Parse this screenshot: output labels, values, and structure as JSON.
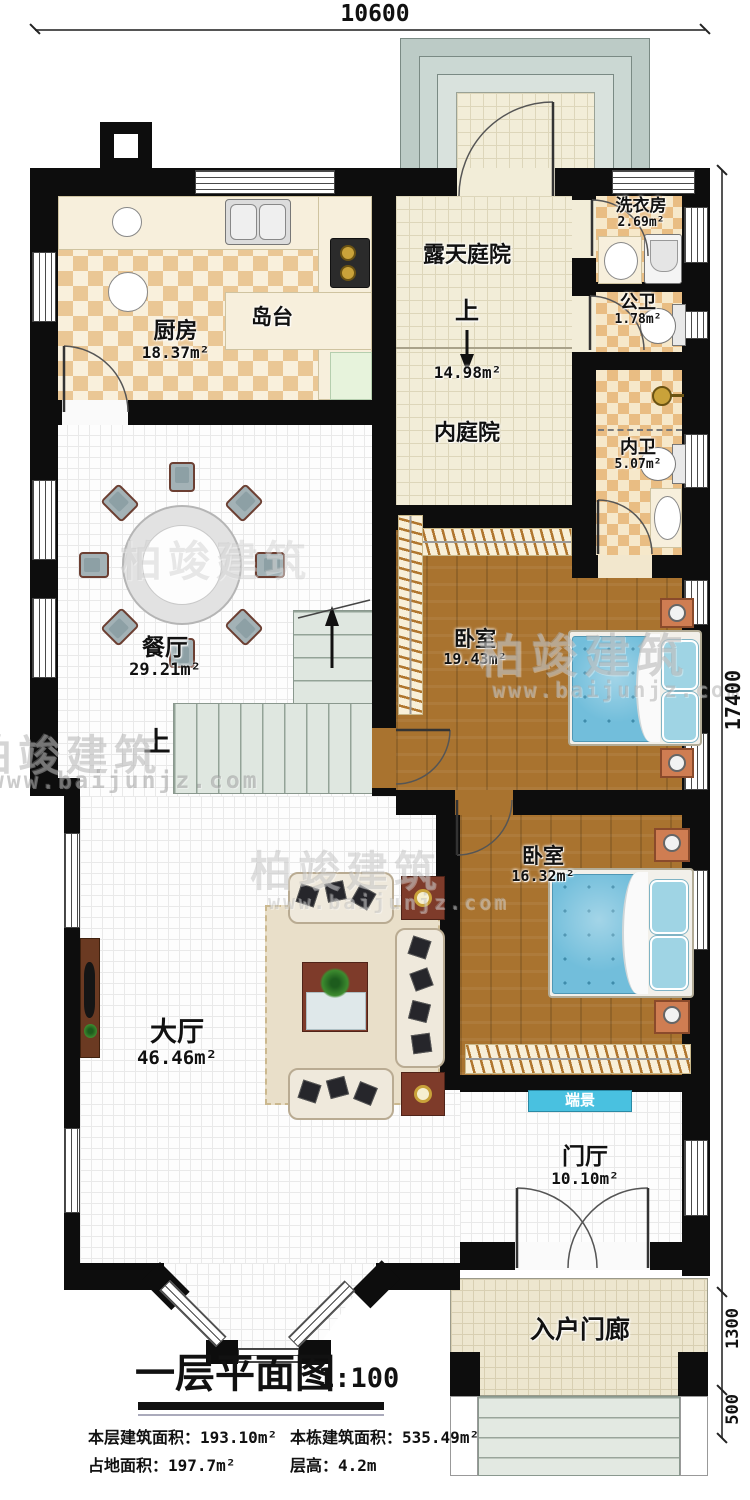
{
  "watermark": {
    "brand": "柏竣建筑",
    "url": "www.baijunjz.com"
  },
  "dimensions": {
    "top": "10600",
    "right": "17400",
    "porch_depth": "1300",
    "steps_depth": "500"
  },
  "rooms": {
    "kitchen": {
      "name": "厨房",
      "area": "18.37m²"
    },
    "island": {
      "name": "岛台"
    },
    "open_courtyard": {
      "name": "露天庭院",
      "up": "上",
      "area": "14.98m²"
    },
    "inner_courtyard": {
      "name": "内庭院"
    },
    "laundry": {
      "name": "洗衣房",
      "area": "2.69m²"
    },
    "public_wc": {
      "name": "公卫",
      "area": "1.78m²"
    },
    "inner_wc": {
      "name": "内卫",
      "area": "5.07m²"
    },
    "bedroom1": {
      "name": "卧室",
      "area": "19.43m²"
    },
    "bedroom2": {
      "name": "卧室",
      "area": "16.32m²"
    },
    "dining": {
      "name": "餐厅",
      "area": "29.21m²",
      "up": "上"
    },
    "living": {
      "name": "大厅",
      "area": "46.46m²"
    },
    "end_view": {
      "name": "端景"
    },
    "foyer": {
      "name": "门厅",
      "area": "10.10m²"
    },
    "porch": {
      "name": "入户门廊"
    }
  },
  "title_block": {
    "title": "一层平面图",
    "scale": "1:100",
    "stats": [
      {
        "label": "本层建筑面积：",
        "value": "193.10m²"
      },
      {
        "label": "本栋建筑面积：",
        "value": "535.49m²"
      },
      {
        "label": "占地面积：",
        "value": "197.7m²"
      },
      {
        "label": "层高：",
        "value": "4.2m"
      }
    ]
  }
}
